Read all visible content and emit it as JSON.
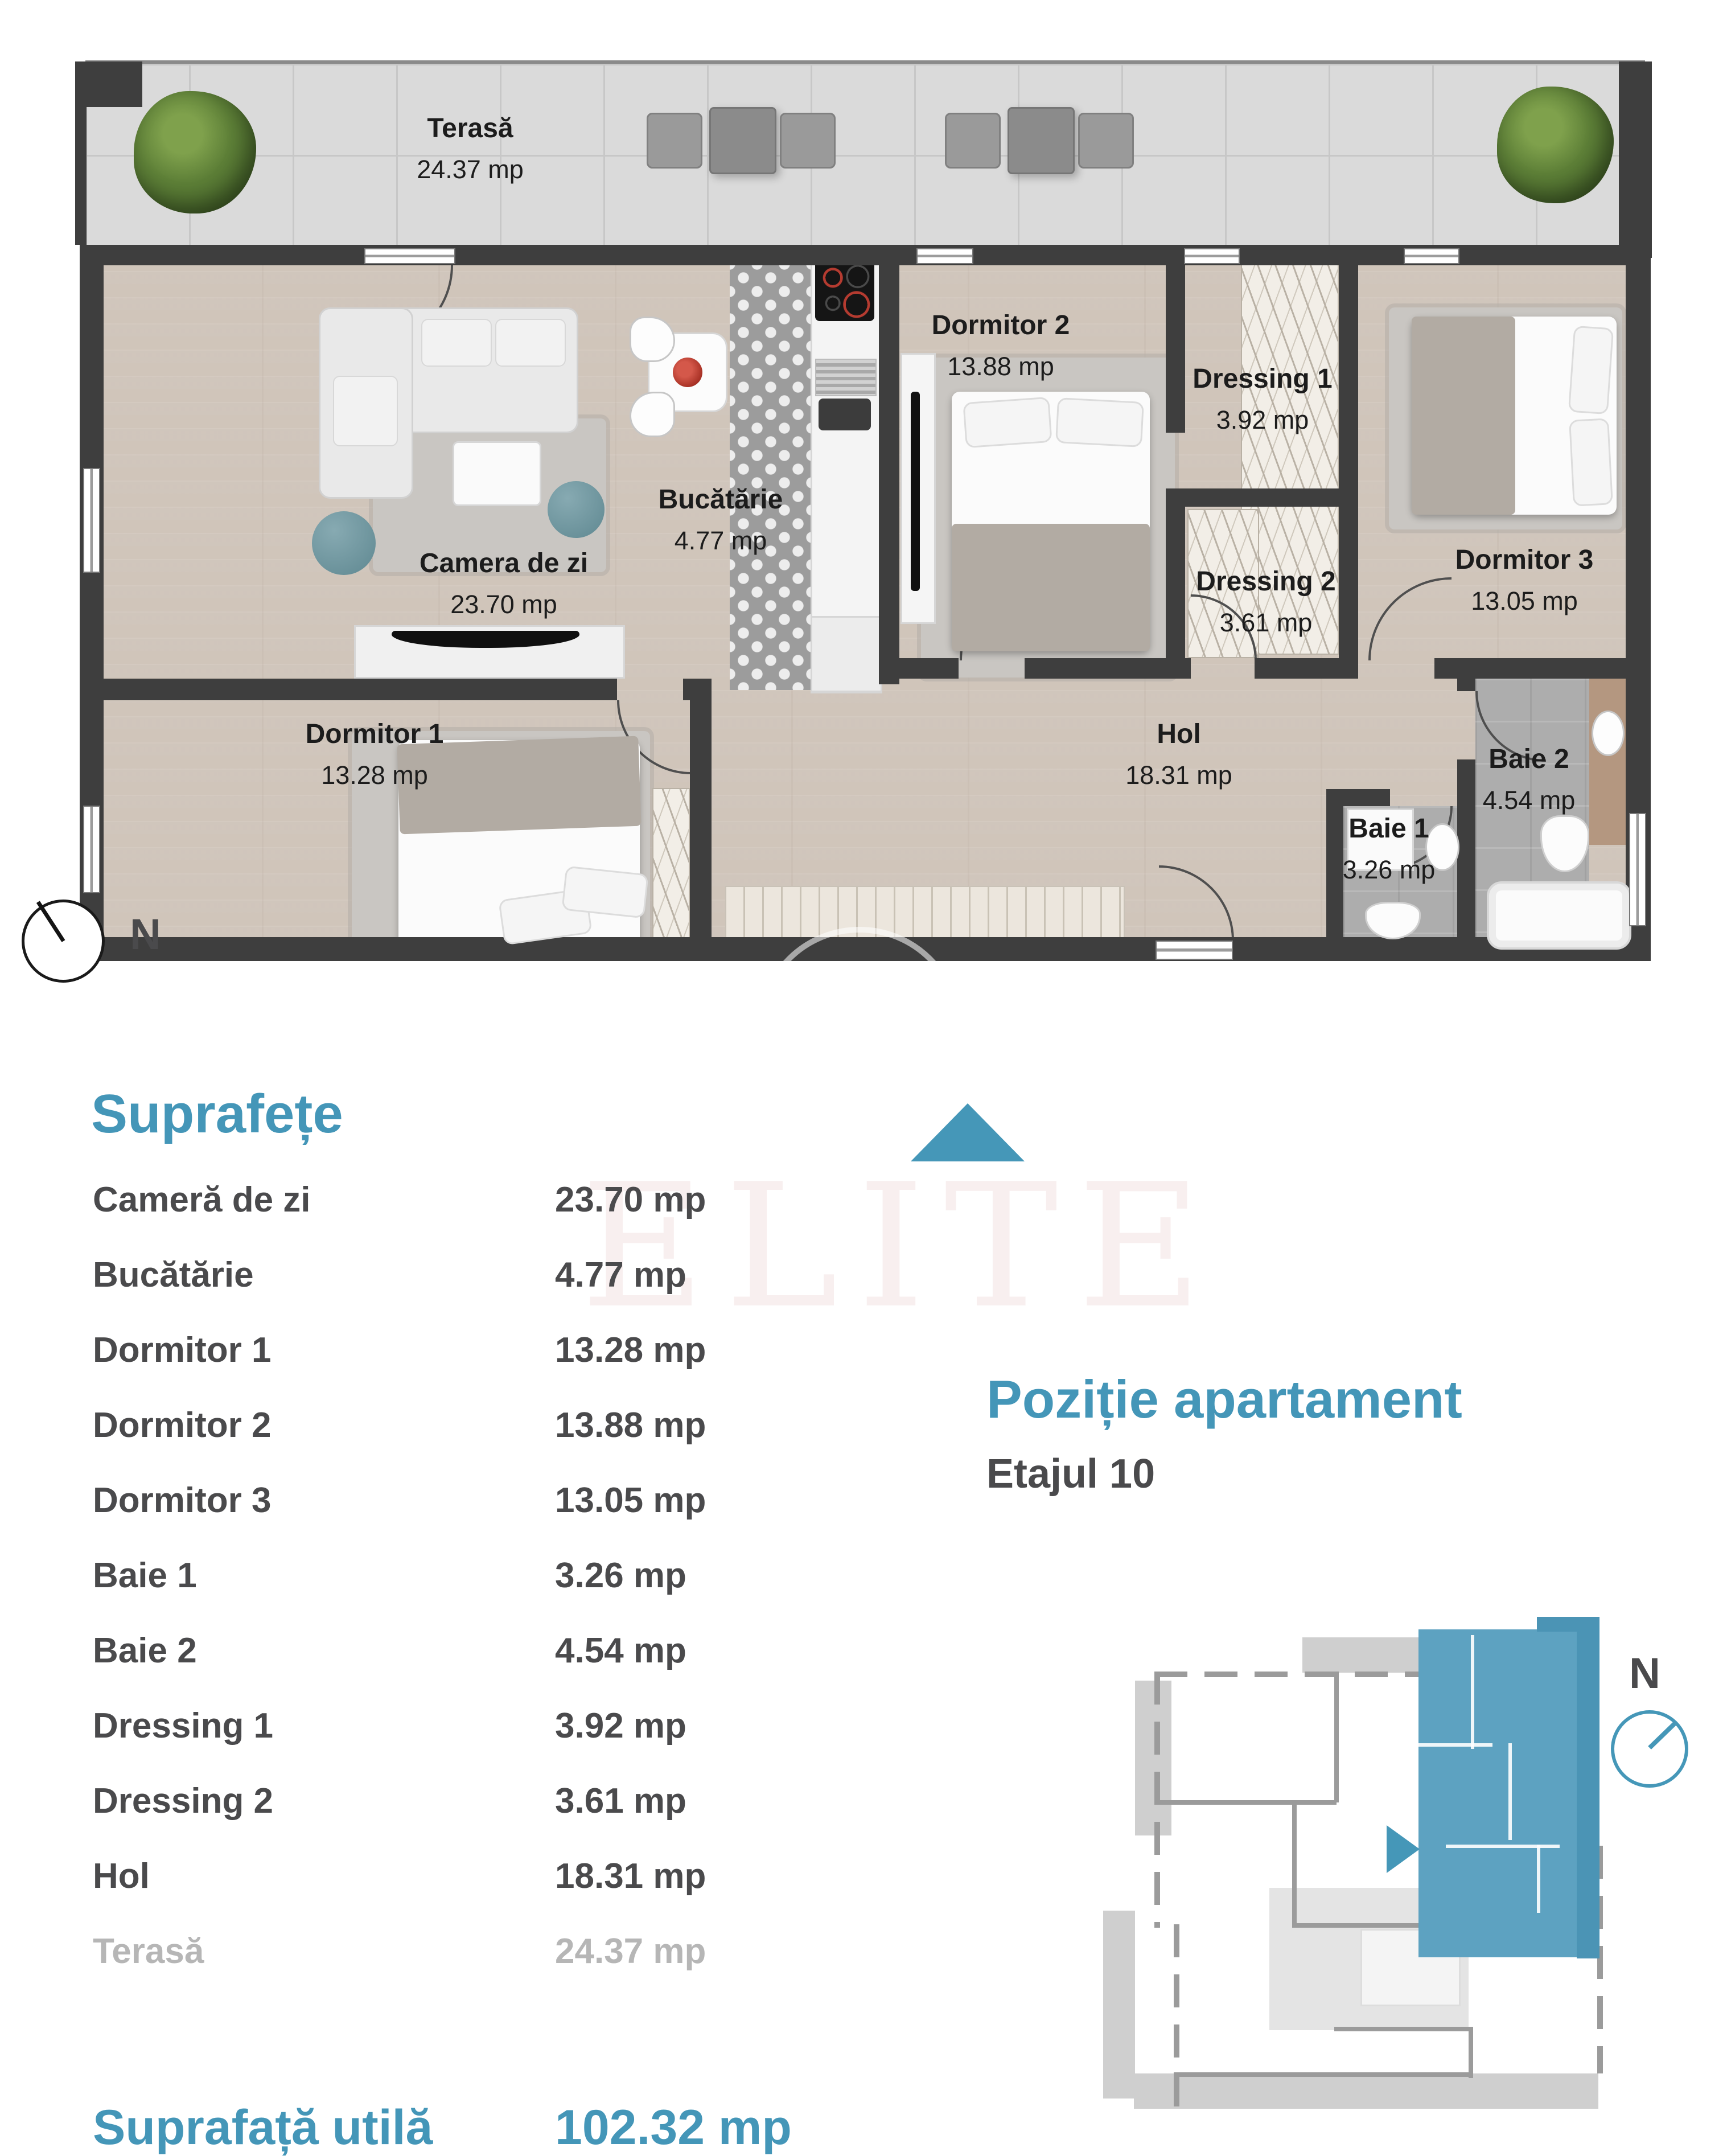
{
  "floor_plan": {
    "compass_label": "N",
    "rooms": [
      {
        "name": "Terasă",
        "area": "24.37 mp"
      },
      {
        "name": "Camera de zi",
        "area": "23.70 mp"
      },
      {
        "name": "Bucătărie",
        "area": "4.77 mp"
      },
      {
        "name": "Dormitor 1",
        "area": "13.28 mp"
      },
      {
        "name": "Dormitor 2",
        "area": "13.88 mp"
      },
      {
        "name": "Dormitor 3",
        "area": "13.05 mp"
      },
      {
        "name": "Dressing 1",
        "area": "3.92 mp"
      },
      {
        "name": "Dressing 2",
        "area": "3.61 mp"
      },
      {
        "name": "Hol",
        "area": "18.31 mp"
      },
      {
        "name": "Baie 1",
        "area": "3.26 mp"
      },
      {
        "name": "Baie 2",
        "area": "4.54 mp"
      }
    ]
  },
  "areas_section": {
    "title": "Suprafețe",
    "rows": [
      {
        "label": "Cameră de zi",
        "value": "23.70 mp"
      },
      {
        "label": "Bucătărie",
        "value": "4.77 mp"
      },
      {
        "label": "Dormitor 1",
        "value": "13.28 mp"
      },
      {
        "label": "Dormitor 2",
        "value": "13.88 mp"
      },
      {
        "label": "Dormitor 3",
        "value": "13.05 mp"
      },
      {
        "label": "Baie 1",
        "value": "3.26 mp"
      },
      {
        "label": "Baie 2",
        "value": "4.54 mp"
      },
      {
        "label": "Dressing 1",
        "value": "3.92 mp"
      },
      {
        "label": "Dressing 2",
        "value": "3.61 mp"
      },
      {
        "label": "Hol",
        "value": "18.31 mp"
      },
      {
        "label": "Terasă",
        "value": "24.37 mp"
      }
    ],
    "total_label": "Suprafață utilă",
    "total_value": "102.32 mp"
  },
  "position_section": {
    "title": "Poziție apartament",
    "subtitle": "Etajul 10",
    "compass_label": "N"
  },
  "watermark": "ELITE",
  "colors": {
    "accent": "#4496b8",
    "text_dark": "#4a4a4c",
    "muted_gray": "#b6b6b6",
    "wall_dark": "#3e3e3e",
    "highlight_fill": "#5da2c1"
  }
}
